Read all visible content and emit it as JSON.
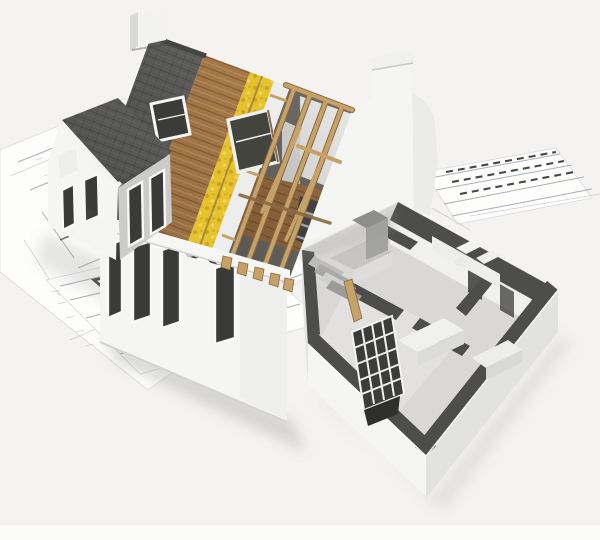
{
  "canvas": {
    "width": 600,
    "height": 540
  },
  "image": {
    "type": "3d-architectural-cutaway-render",
    "alt": "3D rendering of a house construction model standing on architectural blueprints. The roof is peeled back in layers showing gray shingles, wood sheathing, yellow insulation and exposed timber rafters; a single-story wing is cut open revealing the interior floor plan with dark wall tops, kitchen and bathroom fixtures."
  },
  "palette": {
    "background": "#f4f3f1",
    "paper": "#fdfdfc",
    "blueprint_line": "#aab0b8",
    "blueprint_dark": "#47474a",
    "shingle": "#5e5e5d",
    "shingle_dark": "#474746",
    "wood": "#a87a49",
    "wood_dark": "#7c5530",
    "insulation": "#e5c22e",
    "insulation_dark": "#c2a01e",
    "insulation_light": "#f4da60",
    "rafter": "#c6a268",
    "rafter_dark": "#8a6a42",
    "wall_white": "#f5f5f3",
    "wall_shade": "#e2e2e0",
    "wall_top": "#4d4d4b",
    "window_dark": "#3a3a38",
    "floor": "#d9d8d6",
    "attic_floor": "#9c6f42",
    "attic_dark": "#6e4e2c",
    "attic_shadow": "#6f6e6a",
    "fixture_gray": "#c6c5c3",
    "shadow": "#8e8e8c"
  },
  "scene": {
    "elements": [
      "blueprint-sheet-left",
      "blueprint-sheet-floorplan",
      "blueprint-sheet-right",
      "house-model",
      "chimney",
      "main-roof-shingles",
      "roof-layer-sheathing",
      "roof-layer-insulation",
      "roof-layer-membrane",
      "exposed-rafters",
      "roof-window",
      "dormer-window",
      "left-wing",
      "front-wall",
      "dutch-gable",
      "cutaway-wing",
      "interior-walls",
      "kitchen-counter",
      "bathroom-fixtures",
      "radiator-grid",
      "attic-floor"
    ]
  }
}
